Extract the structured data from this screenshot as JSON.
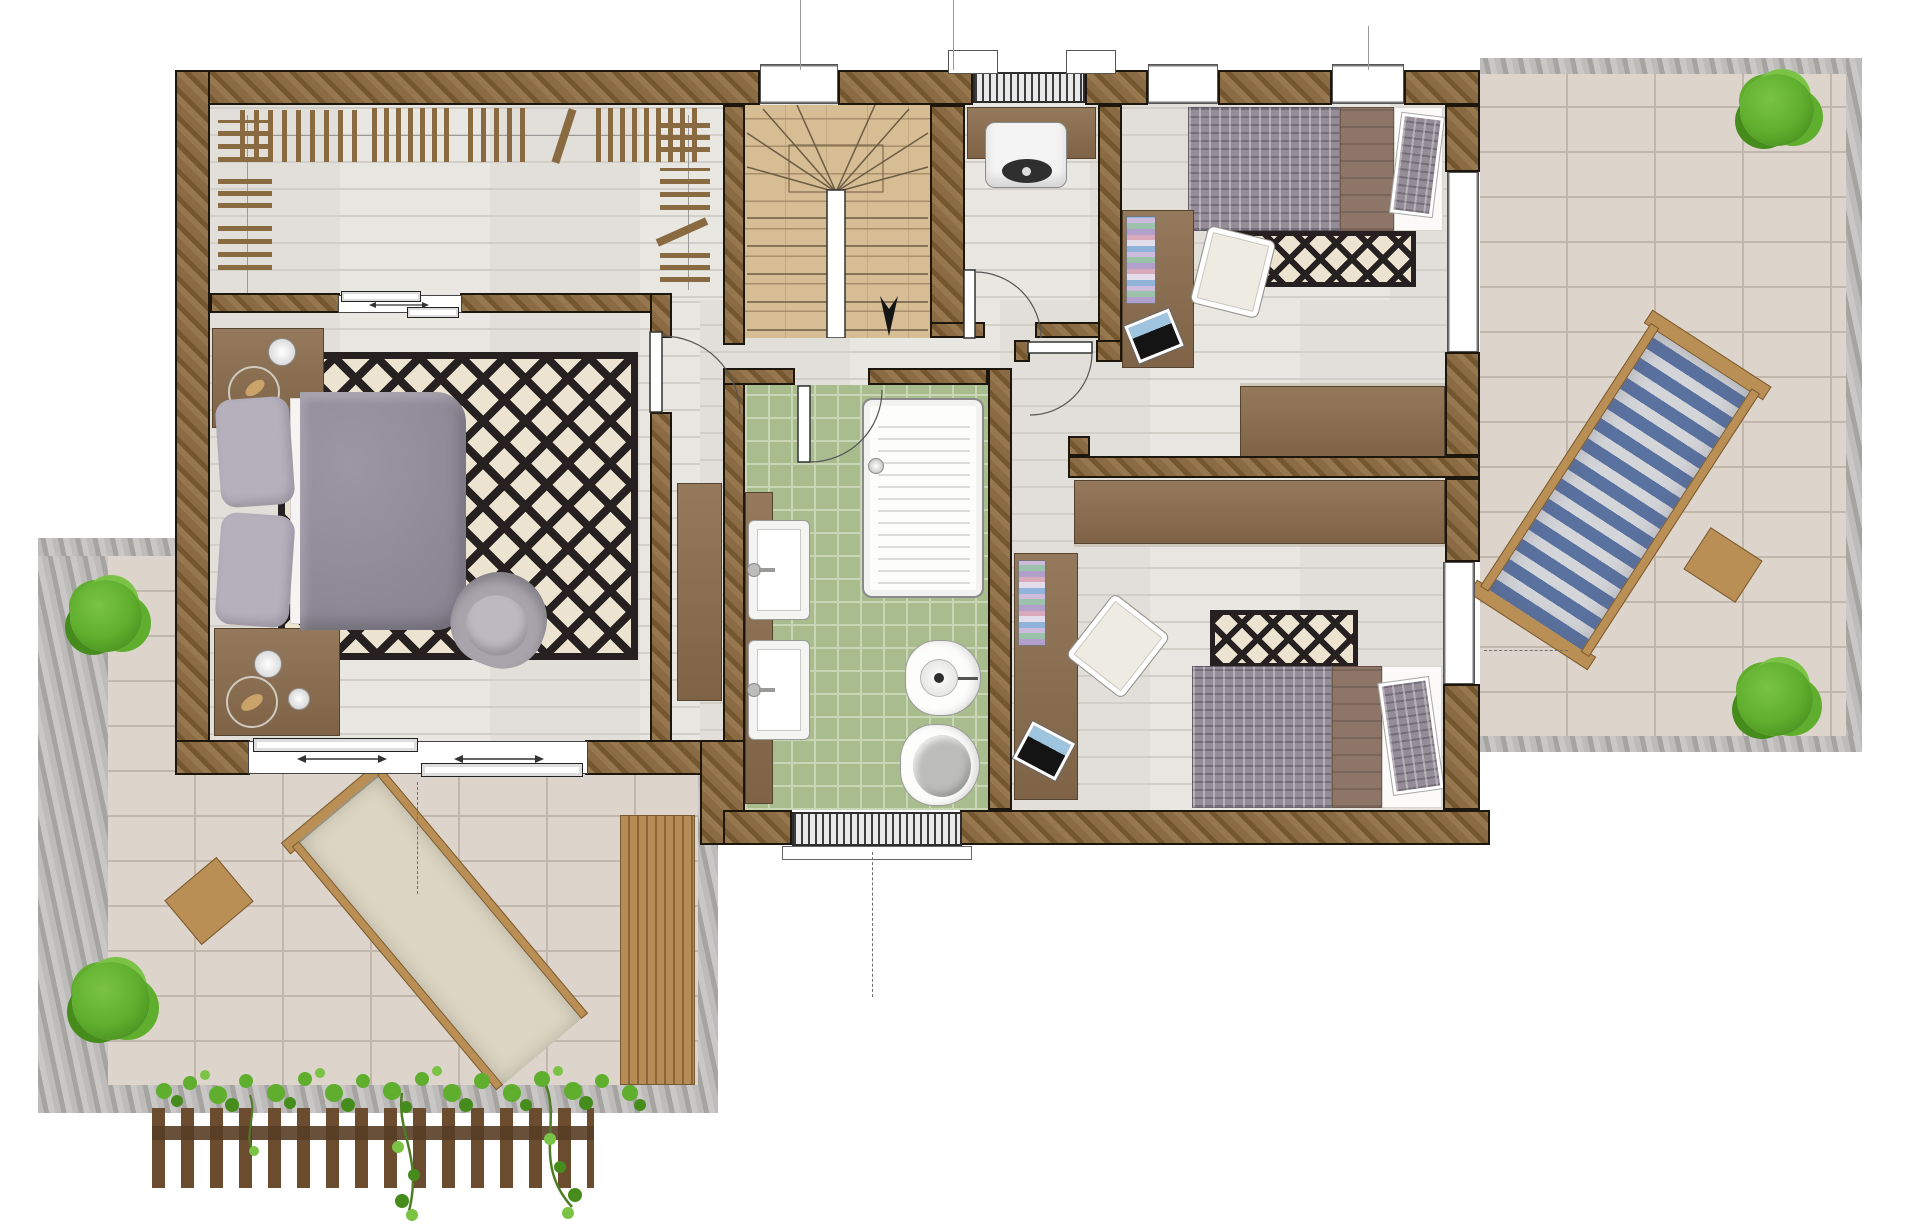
{
  "document": {
    "type": "architectural-floor-plan",
    "floor": "upper-floor",
    "render_style": "top-down color render",
    "visible_text": ""
  },
  "colors": {
    "wall": "#8a6b44",
    "wallHi": "#97784e",
    "wallLo": "#74572f",
    "outline": "#1d160d",
    "wood": "#e8e6e1",
    "woodLine": "#d2cfc8",
    "tan": "#d6bd94",
    "tanLine": "#a9906b",
    "tile": "#a8bc8e",
    "tileLine": "#c9d6b6",
    "paving": "#ddd5cc",
    "pavingLine": "#c2b7ac",
    "stone": "#bdbcba",
    "stoneLo": "#a5a4a1",
    "rugInk": "#262020",
    "rugBg": "#ece4d0",
    "duvet": "#8f8b97",
    "pillow": "#b5b0bc",
    "sheet": "#f5f4f2",
    "printDuvet": "#948d97",
    "blanket": "#8d7668",
    "furn": "#8a6f52",
    "furnEdge": "#57422c",
    "chair": "#eeebe2",
    "leaf": "#5fae2e",
    "leafDark": "#468c1d",
    "leafHi": "#7ac344",
    "fabBlue": "#5a72a0",
    "fabBlueLt": "#d3d5d9",
    "fabCream": "#dcd5c2",
    "frame": "#b98f55"
  },
  "rooms": [
    {
      "id": "walk-in-closet",
      "label": "Walk-in closet",
      "features": [
        "hanging-clothes-racks",
        "sliding-door"
      ]
    },
    {
      "id": "master-bedroom",
      "label": "Master bedroom",
      "furniture": [
        "double-bed",
        "two-nightstands",
        "diamond-rug",
        "armchair",
        "sliding-glass-door"
      ]
    },
    {
      "id": "staircase",
      "label": "Staircase",
      "features": [
        "winder-stairs",
        "center-divider",
        "down-arrow",
        "window"
      ]
    },
    {
      "id": "hallway",
      "label": "Hallway",
      "furniture": [
        "tall-cabinet"
      ]
    },
    {
      "id": "utility-room",
      "label": "Utility room",
      "furniture": [
        "counter",
        "wall-boiler",
        "door"
      ]
    },
    {
      "id": "bedroom-2",
      "label": "Bedroom 2",
      "furniture": [
        "single-bed",
        "desk",
        "books",
        "laptop",
        "chair",
        "wardrobe",
        "diamond-rug",
        "two-windows"
      ]
    },
    {
      "id": "bedroom-3",
      "label": "Bedroom 3",
      "furniture": [
        "single-bed",
        "desk",
        "books",
        "laptop",
        "chair",
        "wardrobe",
        "diamond-rug",
        "window"
      ]
    },
    {
      "id": "bathroom",
      "label": "Bathroom",
      "furniture": [
        "shower-tray",
        "twin-sinks",
        "bidet",
        "toilet",
        "door",
        "window"
      ]
    },
    {
      "id": "terrace-right",
      "label": "Right terrace",
      "furniture": [
        "striped-sun-lounger",
        "side-table",
        "plant",
        "plant"
      ]
    },
    {
      "id": "terrace-left",
      "label": "Lower-left terrace",
      "furniture": [
        "cream-sun-lounger",
        "side-table",
        "plant",
        "plant",
        "wood-deck-strip",
        "pergola-with-ivy"
      ]
    }
  ]
}
